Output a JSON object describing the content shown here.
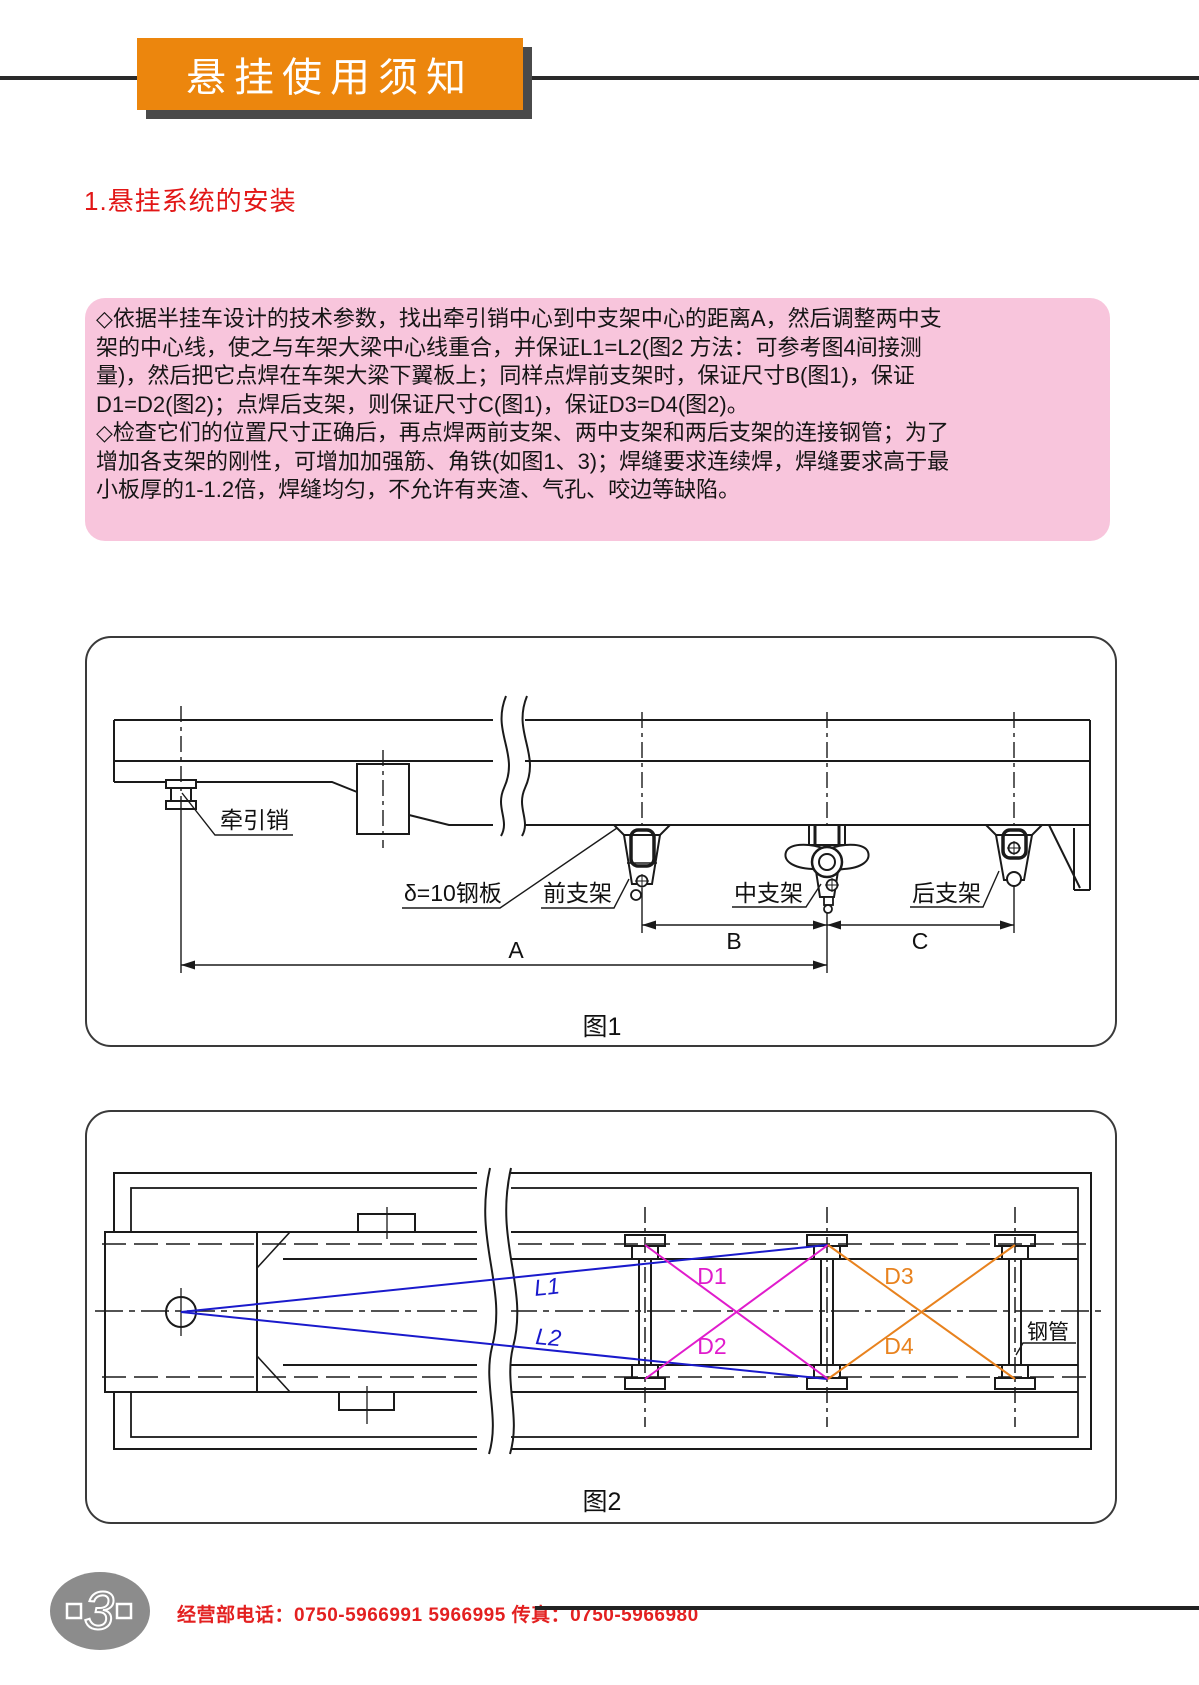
{
  "banner": {
    "title": "悬挂使用须知"
  },
  "section": {
    "heading": "1.悬挂系统的安装"
  },
  "note": {
    "lines": [
      "◇依据半挂车设计的技术参数，找出牵引销中心到中支架中心的距离A，然后调整两中支",
      "架的中心线，使之与车架大梁中心线重合，并保证L1=L2(图2 方法：可参考图4间接测",
      "量)，然后把它点焊在车架大梁下翼板上；同样点焊前支架时，保证尺寸B(图1)，保证",
      "D1=D2(图2)；点焊后支架，则保证尺寸C(图1)，保证D3=D4(图2)。",
      "◇检查它们的位置尺寸正确后，再点焊两前支架、两中支架和两后支架的连接钢管；为了",
      "增加各支架的刚性，可增加加强筋、角铁(如图1、3)；焊缝要求连续焊，焊缝要求高于最",
      "小板厚的1-1.2倍，焊缝均匀，不允许有夹渣、气孔、咬边等缺陷。"
    ]
  },
  "figure1": {
    "caption": "图1",
    "labels": {
      "kingpin": "牵引销",
      "plate": "δ=10钢板",
      "front_bracket": "前支架",
      "middle_bracket": "中支架",
      "rear_bracket": "后支架",
      "dim_a": "A",
      "dim_b": "B",
      "dim_c": "C"
    }
  },
  "figure2": {
    "caption": "图2",
    "labels": {
      "l1": "L1",
      "l2": "L2",
      "d1": "D1",
      "d2": "D2",
      "d3": "D3",
      "d4": "D4",
      "steel_tube": "钢管"
    },
    "colors": {
      "l_lines": "#1a1acc",
      "d12_lines": "#e01ccc",
      "d34_lines": "#e8821e"
    }
  },
  "footer": {
    "page_number": "3",
    "contact": "经营部电话：0750-5966991 5966995 传真：0750-5966980"
  },
  "theme": {
    "banner_orange": "#ec860d",
    "heading_red": "#e21616",
    "note_pink": "#f8c5dc",
    "footer_red": "#e32020"
  }
}
